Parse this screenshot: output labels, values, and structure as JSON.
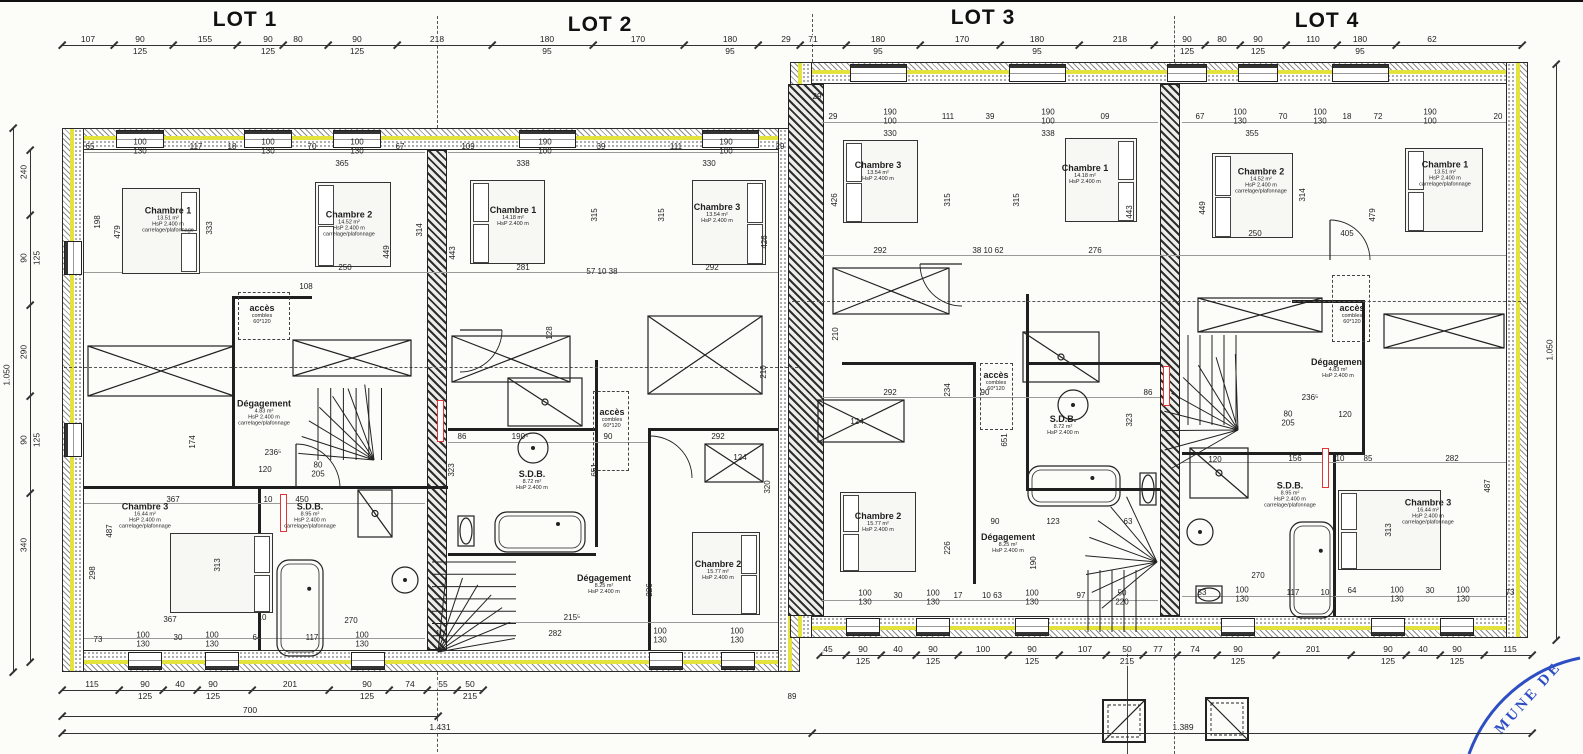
{
  "lot_titles": [
    {
      "label": "LOT 1"
    },
    {
      "label": "LOT 2"
    },
    {
      "label": "LOT 3"
    },
    {
      "label": "LOT 4"
    }
  ],
  "stamp": {
    "text": "MUNE DE",
    "color": "#2e4ec4"
  },
  "colors": {
    "insulation_yellow": "#e4e23d",
    "stamp_blue": "#2e4ec4",
    "mark_red": "#e23535"
  },
  "room_labels": [
    {
      "x": 168,
      "y": 220,
      "name": "Chambre 1",
      "lines": [
        "13.51 m²",
        "HsP 2.400 m",
        "carrelage/plafonnage"
      ]
    },
    {
      "x": 349,
      "y": 224,
      "name": "Chambre 2",
      "lines": [
        "14.52 m²",
        "HsP 2.400 m",
        "carrelage/plafonnage"
      ]
    },
    {
      "x": 264,
      "y": 413,
      "name": "Dégagement",
      "lines": [
        "4.83 m²",
        "HsP 2.400 m",
        "carrelage/plafonnage"
      ]
    },
    {
      "x": 145,
      "y": 516,
      "name": "Chambre 3",
      "lines": [
        "16.44 m²",
        "HsP 2.400 m",
        "carrelage/plafonnage"
      ]
    },
    {
      "x": 310,
      "y": 516,
      "name": "S.D.B.",
      "lines": [
        "8.95 m²",
        "HsP 2.400 m",
        "carrelage/plafonnage"
      ]
    },
    {
      "x": 262,
      "y": 314,
      "name": "accès",
      "lines": [
        "combles",
        "60*120"
      ]
    },
    {
      "x": 513,
      "y": 216,
      "name": "Chambre 1",
      "lines": [
        "14.18 m²",
        "HsP 2.400 m"
      ]
    },
    {
      "x": 717,
      "y": 213,
      "name": "Chambre 3",
      "lines": [
        "13.54 m²",
        "HsP 2.400 m"
      ]
    },
    {
      "x": 532,
      "y": 480,
      "name": "S.D.B.",
      "lines": [
        "8.72 m²",
        "HsP 2.400 m"
      ]
    },
    {
      "x": 604,
      "y": 584,
      "name": "Dégagement",
      "lines": [
        "8.25 m²",
        "HsP 2.400 m"
      ]
    },
    {
      "x": 718,
      "y": 570,
      "name": "Chambre 2",
      "lines": [
        "15.77 m²",
        "HsP 2.400 m"
      ]
    },
    {
      "x": 612,
      "y": 418,
      "name": "accès",
      "lines": [
        "combles",
        "60*120"
      ]
    },
    {
      "x": 878,
      "y": 171,
      "name": "Chambre 3",
      "lines": [
        "13.54 m²",
        "HsP 2.400 m"
      ]
    },
    {
      "x": 1085,
      "y": 174,
      "name": "Chambre 1",
      "lines": [
        "14.18 m²",
        "HsP 2.400 m"
      ]
    },
    {
      "x": 1063,
      "y": 425,
      "name": "S.D.B.",
      "lines": [
        "8.72 m²",
        "HsP 2.400 m"
      ]
    },
    {
      "x": 996,
      "y": 381,
      "name": "accès",
      "lines": [
        "combles",
        "60*120"
      ]
    },
    {
      "x": 878,
      "y": 522,
      "name": "Chambre 2",
      "lines": [
        "15.77 m²",
        "HsP 2.400 m"
      ]
    },
    {
      "x": 1008,
      "y": 543,
      "name": "Dégagement",
      "lines": [
        "8.25 m²",
        "HsP 2.400 m"
      ]
    },
    {
      "x": 1261,
      "y": 181,
      "name": "Chambre 2",
      "lines": [
        "14.52 m²",
        "HsP 2.400 m",
        "carrelage/plafonnage"
      ]
    },
    {
      "x": 1445,
      "y": 174,
      "name": "Chambre 1",
      "lines": [
        "13.51 m²",
        "HsP 2.400 m",
        "carrelage/plafonnage"
      ]
    },
    {
      "x": 1352,
      "y": 314,
      "name": "accès",
      "lines": [
        "combles",
        "60*120"
      ]
    },
    {
      "x": 1338,
      "y": 368,
      "name": "Dégagement",
      "lines": [
        "4.83 m²",
        "HsP 2.400 m"
      ]
    },
    {
      "x": 1290,
      "y": 495,
      "name": "S.D.B.",
      "lines": [
        "8.95 m²",
        "HsP 2.400 m",
        "carrelage/plafonnage"
      ]
    },
    {
      "x": 1428,
      "y": 512,
      "name": "Chambre 3",
      "lines": [
        "16.44 m²",
        "HsP 2.400 m",
        "carrelage/plafonnage"
      ]
    }
  ],
  "chains": [
    {
      "name": "top-dim-chain",
      "dir": "h",
      "x0": 62,
      "x1": 1522,
      "y": 45,
      "items": [
        {
          "x": 88,
          "a": "107"
        },
        {
          "x": 140,
          "a": "90",
          "b": "125"
        },
        {
          "x": 205,
          "a": "155"
        },
        {
          "x": 268,
          "a": "90",
          "b": "125"
        },
        {
          "x": 298,
          "a": "80"
        },
        {
          "x": 357,
          "a": "90",
          "b": "125"
        },
        {
          "x": 437,
          "a": "218"
        },
        {
          "x": 547,
          "a": "180",
          "b": "95"
        },
        {
          "x": 638,
          "a": "170"
        },
        {
          "x": 730,
          "a": "180",
          "b": "95"
        },
        {
          "x": 786,
          "a": "29"
        },
        {
          "x": 813,
          "a": "71"
        },
        {
          "x": 878,
          "a": "180",
          "b": "95"
        },
        {
          "x": 962,
          "a": "170"
        },
        {
          "x": 1037,
          "a": "180",
          "b": "95"
        },
        {
          "x": 1120,
          "a": "218"
        },
        {
          "x": 1187,
          "a": "90",
          "b": "125"
        },
        {
          "x": 1222,
          "a": "80"
        },
        {
          "x": 1258,
          "a": "90",
          "b": "125"
        },
        {
          "x": 1313,
          "a": "110"
        },
        {
          "x": 1360,
          "a": "180",
          "b": "95"
        },
        {
          "x": 1432,
          "a": "62"
        }
      ]
    },
    {
      "name": "bottom-right-dim-chain",
      "dir": "h",
      "x0": 820,
      "x1": 1532,
      "y": 655,
      "items": [
        {
          "x": 828,
          "a": "45"
        },
        {
          "x": 863,
          "a": "90",
          "b": "125"
        },
        {
          "x": 898,
          "a": "40"
        },
        {
          "x": 933,
          "a": "90",
          "b": "125"
        },
        {
          "x": 983,
          "a": "100"
        },
        {
          "x": 1032,
          "a": "90",
          "b": "125"
        },
        {
          "x": 1085,
          "a": "107"
        },
        {
          "x": 1127,
          "a": "50",
          "b": "215"
        },
        {
          "x": 1158,
          "a": "77"
        },
        {
          "x": 1195,
          "a": "74"
        },
        {
          "x": 1238,
          "a": "90",
          "b": "125"
        },
        {
          "x": 1313,
          "a": "201"
        },
        {
          "x": 1388,
          "a": "90",
          "b": "125"
        },
        {
          "x": 1423,
          "a": "40"
        },
        {
          "x": 1457,
          "a": "90",
          "b": "125"
        },
        {
          "x": 1510,
          "a": "115"
        }
      ]
    },
    {
      "name": "bottom-left-dim-chain",
      "dir": "h",
      "x0": 62,
      "x1": 483,
      "y": 690,
      "items": [
        {
          "x": 92,
          "a": "115"
        },
        {
          "x": 145,
          "a": "90",
          "b": "125"
        },
        {
          "x": 180,
          "a": "40"
        },
        {
          "x": 213,
          "a": "90",
          "b": "125"
        },
        {
          "x": 290,
          "a": "201"
        },
        {
          "x": 367,
          "a": "90",
          "b": "125"
        },
        {
          "x": 410,
          "a": "74"
        },
        {
          "x": 443,
          "a": "55"
        },
        {
          "x": 470,
          "a": "50",
          "b": "215"
        }
      ]
    },
    {
      "name": "left-dim-chain",
      "dir": "v",
      "x": 30,
      "y0": 150,
      "y1": 662,
      "items": [
        {
          "y": 172,
          "a": "240"
        },
        {
          "y": 258,
          "a": "90",
          "b": "125"
        },
        {
          "y": 352,
          "a": "290"
        },
        {
          "y": 440,
          "a": "90",
          "b": "125"
        },
        {
          "y": 545,
          "a": "340"
        }
      ]
    },
    {
      "name": "left-overall-chain",
      "dir": "v",
      "x": 13,
      "y0": 128,
      "y1": 672,
      "items": [
        {
          "y": 375,
          "a": "1.050"
        }
      ]
    },
    {
      "name": "right-overall-chain",
      "dir": "v",
      "x": 1556,
      "y0": 64,
      "y1": 640,
      "items": [
        {
          "y": 350,
          "a": "1.050"
        }
      ]
    },
    {
      "name": "total-700-line",
      "dir": "h",
      "x0": 62,
      "x1": 438,
      "y": 716,
      "items": [
        {
          "x": 250,
          "a": "700"
        }
      ]
    },
    {
      "name": "total-line",
      "dir": "h",
      "x0": 62,
      "x1": 1532,
      "y": 733,
      "items": [
        {
          "x": 440,
          "a": "1.431"
        },
        {
          "x": 1183,
          "a": "1.389"
        }
      ]
    }
  ],
  "annotations": [
    {
      "x": 90,
      "y": 147,
      "a": "65"
    },
    {
      "x": 140,
      "y": 147,
      "a": "100",
      "b": "130"
    },
    {
      "x": 196,
      "y": 147,
      "a": "117"
    },
    {
      "x": 232,
      "y": 147,
      "a": "18"
    },
    {
      "x": 268,
      "y": 147,
      "a": "100",
      "b": "130"
    },
    {
      "x": 312,
      "y": 147,
      "a": "70"
    },
    {
      "x": 357,
      "y": 147,
      "a": "100",
      "b": "130"
    },
    {
      "x": 400,
      "y": 147,
      "a": "67"
    },
    {
      "x": 468,
      "y": 147,
      "a": "109"
    },
    {
      "x": 545,
      "y": 147,
      "a": "190",
      "b": "100"
    },
    {
      "x": 601,
      "y": 147,
      "a": "39"
    },
    {
      "x": 676,
      "y": 147,
      "a": "111"
    },
    {
      "x": 726,
      "y": 147,
      "a": "190",
      "b": "100"
    },
    {
      "x": 780,
      "y": 147,
      "a": "29"
    },
    {
      "x": 342,
      "y": 164,
      "a": "365"
    },
    {
      "x": 523,
      "y": 164,
      "a": "338"
    },
    {
      "x": 709,
      "y": 164,
      "a": "330"
    },
    {
      "x": 833,
      "y": 117,
      "a": "29"
    },
    {
      "x": 890,
      "y": 117,
      "a": "190",
      "b": "100"
    },
    {
      "x": 948,
      "y": 117,
      "a": "111"
    },
    {
      "x": 990,
      "y": 117,
      "a": "39"
    },
    {
      "x": 1048,
      "y": 117,
      "a": "190",
      "b": "100"
    },
    {
      "x": 1105,
      "y": 117,
      "a": "09"
    },
    {
      "x": 1200,
      "y": 117,
      "a": "67"
    },
    {
      "x": 1240,
      "y": 117,
      "a": "100",
      "b": "130"
    },
    {
      "x": 1283,
      "y": 117,
      "a": "70"
    },
    {
      "x": 1320,
      "y": 117,
      "a": "100",
      "b": "130"
    },
    {
      "x": 1347,
      "y": 117,
      "a": "18"
    },
    {
      "x": 1378,
      "y": 117,
      "a": "72"
    },
    {
      "x": 1430,
      "y": 117,
      "a": "190",
      "b": "100"
    },
    {
      "x": 1498,
      "y": 117,
      "a": "20"
    },
    {
      "x": 890,
      "y": 134,
      "a": "330"
    },
    {
      "x": 1048,
      "y": 134,
      "a": "338"
    },
    {
      "x": 1252,
      "y": 134,
      "a": "355"
    },
    {
      "x": 345,
      "y": 268,
      "a": "250"
    },
    {
      "x": 523,
      "y": 268,
      "a": "281"
    },
    {
      "x": 602,
      "y": 272,
      "a": "57 10 38"
    },
    {
      "x": 712,
      "y": 268,
      "a": "292"
    },
    {
      "x": 880,
      "y": 251,
      "a": "292"
    },
    {
      "x": 988,
      "y": 251,
      "a": "38 10 62"
    },
    {
      "x": 1095,
      "y": 251,
      "a": "276"
    },
    {
      "x": 1255,
      "y": 234,
      "a": "250"
    },
    {
      "x": 1347,
      "y": 234,
      "a": "405"
    },
    {
      "x": 306,
      "y": 287,
      "a": "108"
    },
    {
      "x": 98,
      "y": 222,
      "a": "198",
      "rot": 1
    },
    {
      "x": 118,
      "y": 232,
      "a": "479",
      "rot": 1
    },
    {
      "x": 210,
      "y": 228,
      "a": "333",
      "rot": 1
    },
    {
      "x": 387,
      "y": 252,
      "a": "449",
      "rot": 1
    },
    {
      "x": 420,
      "y": 230,
      "a": "314",
      "rot": 1
    },
    {
      "x": 453,
      "y": 253,
      "a": "443",
      "rot": 1
    },
    {
      "x": 595,
      "y": 215,
      "a": "315",
      "rot": 1
    },
    {
      "x": 662,
      "y": 215,
      "a": "315",
      "rot": 1
    },
    {
      "x": 765,
      "y": 242,
      "a": "426",
      "rot": 1
    },
    {
      "x": 835,
      "y": 200,
      "a": "426",
      "rot": 1
    },
    {
      "x": 948,
      "y": 200,
      "a": "315",
      "rot": 1
    },
    {
      "x": 1017,
      "y": 200,
      "a": "315",
      "rot": 1
    },
    {
      "x": 1130,
      "y": 212,
      "a": "443",
      "rot": 1
    },
    {
      "x": 1203,
      "y": 208,
      "a": "449",
      "rot": 1
    },
    {
      "x": 1303,
      "y": 195,
      "a": "314",
      "rot": 1
    },
    {
      "x": 1373,
      "y": 215,
      "a": "479",
      "rot": 1
    },
    {
      "x": 948,
      "y": 390,
      "a": "234",
      "rot": 1
    },
    {
      "x": 550,
      "y": 333,
      "a": "128",
      "rot": 1
    },
    {
      "x": 595,
      "y": 470,
      "a": "651",
      "rot": 1
    },
    {
      "x": 1005,
      "y": 440,
      "a": "651",
      "rot": 1
    },
    {
      "x": 836,
      "y": 334,
      "a": "210",
      "rot": 1
    },
    {
      "x": 764,
      "y": 372,
      "a": "210",
      "rot": 1
    },
    {
      "x": 452,
      "y": 470,
      "a": "323",
      "rot": 1
    },
    {
      "x": 1130,
      "y": 420,
      "a": "323",
      "rot": 1
    },
    {
      "x": 193,
      "y": 442,
      "a": "174",
      "rot": 1
    },
    {
      "x": 110,
      "y": 531,
      "a": "487",
      "rot": 1
    },
    {
      "x": 93,
      "y": 573,
      "a": "298",
      "rot": 1
    },
    {
      "x": 218,
      "y": 565,
      "a": "313",
      "rot": 1
    },
    {
      "x": 1389,
      "y": 530,
      "a": "313",
      "rot": 1
    },
    {
      "x": 1488,
      "y": 486,
      "a": "487",
      "rot": 1
    },
    {
      "x": 948,
      "y": 548,
      "a": "226",
      "rot": 1
    },
    {
      "x": 650,
      "y": 590,
      "a": "226",
      "rot": 1
    },
    {
      "x": 1034,
      "y": 563,
      "a": "190",
      "rot": 1
    },
    {
      "x": 768,
      "y": 487,
      "a": "320",
      "rot": 1
    },
    {
      "x": 273,
      "y": 453,
      "a": "236⁵"
    },
    {
      "x": 265,
      "y": 470,
      "a": "120"
    },
    {
      "x": 318,
      "y": 470,
      "a": "80",
      "b": "205"
    },
    {
      "x": 1310,
      "y": 398,
      "a": "236⁵"
    },
    {
      "x": 1288,
      "y": 419,
      "a": "80",
      "b": "205"
    },
    {
      "x": 1345,
      "y": 415,
      "a": "120"
    },
    {
      "x": 173,
      "y": 500,
      "a": "367"
    },
    {
      "x": 268,
      "y": 500,
      "a": "10"
    },
    {
      "x": 302,
      "y": 500,
      "a": "450"
    },
    {
      "x": 170,
      "y": 620,
      "a": "367"
    },
    {
      "x": 262,
      "y": 618,
      "a": "10"
    },
    {
      "x": 351,
      "y": 621,
      "a": "270"
    },
    {
      "x": 890,
      "y": 393,
      "a": "292"
    },
    {
      "x": 985,
      "y": 393,
      "a": "90"
    },
    {
      "x": 1148,
      "y": 393,
      "a": "86"
    },
    {
      "x": 857,
      "y": 422,
      "a": "124"
    },
    {
      "x": 462,
      "y": 437,
      "a": "86"
    },
    {
      "x": 520,
      "y": 437,
      "a": "190⁵"
    },
    {
      "x": 608,
      "y": 437,
      "a": "90"
    },
    {
      "x": 718,
      "y": 437,
      "a": "292"
    },
    {
      "x": 740,
      "y": 458,
      "a": "124"
    },
    {
      "x": 572,
      "y": 618,
      "a": "215⁵"
    },
    {
      "x": 555,
      "y": 634,
      "a": "282"
    },
    {
      "x": 660,
      "y": 636,
      "a": "100",
      "b": "130"
    },
    {
      "x": 737,
      "y": 636,
      "a": "100",
      "b": "130"
    },
    {
      "x": 440,
      "y": 634,
      "a": "10"
    },
    {
      "x": 98,
      "y": 640,
      "a": "73"
    },
    {
      "x": 143,
      "y": 640,
      "a": "100",
      "b": "130"
    },
    {
      "x": 178,
      "y": 638,
      "a": "30"
    },
    {
      "x": 212,
      "y": 640,
      "a": "100",
      "b": "130"
    },
    {
      "x": 257,
      "y": 638,
      "a": "64"
    },
    {
      "x": 312,
      "y": 638,
      "a": "117"
    },
    {
      "x": 362,
      "y": 640,
      "a": "100",
      "b": "130"
    },
    {
      "x": 995,
      "y": 522,
      "a": "90"
    },
    {
      "x": 1053,
      "y": 522,
      "a": "123"
    },
    {
      "x": 1128,
      "y": 522,
      "a": "63"
    },
    {
      "x": 865,
      "y": 598,
      "a": "100",
      "b": "130"
    },
    {
      "x": 898,
      "y": 596,
      "a": "30"
    },
    {
      "x": 933,
      "y": 598,
      "a": "100",
      "b": "130"
    },
    {
      "x": 958,
      "y": 596,
      "a": "17"
    },
    {
      "x": 992,
      "y": 596,
      "a": "10 63"
    },
    {
      "x": 1032,
      "y": 598,
      "a": "100",
      "b": "130"
    },
    {
      "x": 1081,
      "y": 596,
      "a": "97"
    },
    {
      "x": 1122,
      "y": 598,
      "a": "50",
      "b": "220"
    },
    {
      "x": 1215,
      "y": 460,
      "a": "120"
    },
    {
      "x": 1258,
      "y": 576,
      "a": "270"
    },
    {
      "x": 1295,
      "y": 459,
      "a": "156"
    },
    {
      "x": 1340,
      "y": 459,
      "a": "10"
    },
    {
      "x": 1368,
      "y": 459,
      "a": "85"
    },
    {
      "x": 1452,
      "y": 459,
      "a": "282"
    },
    {
      "x": 1202,
      "y": 593,
      "a": "53"
    },
    {
      "x": 1242,
      "y": 595,
      "a": "100",
      "b": "130"
    },
    {
      "x": 1293,
      "y": 593,
      "a": "117"
    },
    {
      "x": 1325,
      "y": 593,
      "a": "10"
    },
    {
      "x": 1352,
      "y": 591,
      "a": "64"
    },
    {
      "x": 1397,
      "y": 595,
      "a": "100",
      "b": "130"
    },
    {
      "x": 1430,
      "y": 591,
      "a": "30"
    },
    {
      "x": 1463,
      "y": 595,
      "a": "100",
      "b": "130"
    },
    {
      "x": 1510,
      "y": 593,
      "a": "73"
    },
    {
      "x": 792,
      "y": 697,
      "a": "89"
    },
    {
      "x": 817,
      "y": 97,
      "a": "29"
    }
  ]
}
